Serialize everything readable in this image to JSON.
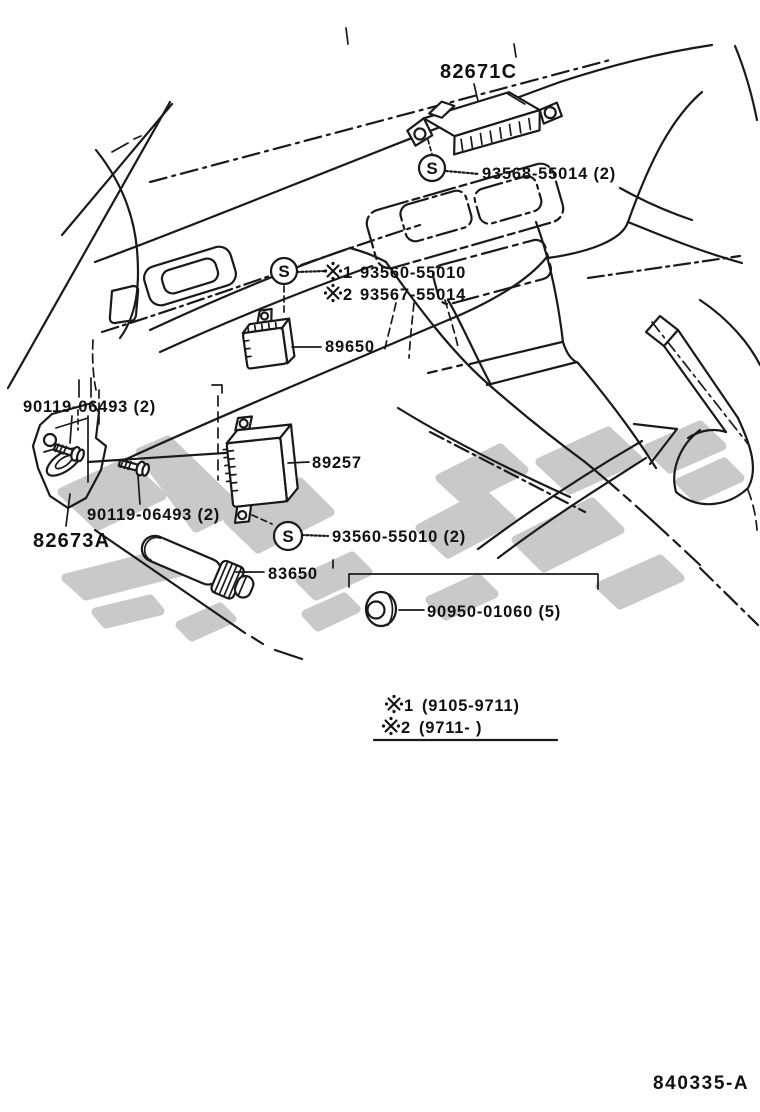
{
  "figure_number": "840335-A",
  "colors": {
    "line": "#1a1a1a",
    "watermark": "#c9c9c9",
    "background": "#ffffff"
  },
  "symbols": {
    "s_marker": "S",
    "reference_mark": "※"
  },
  "callouts": {
    "ecu_82671c": "82671C",
    "screw_93568": "93568-55014 (2)",
    "variant_screw_1": {
      "ref": "1",
      "part": "93560-55010"
    },
    "variant_screw_2": {
      "ref": "2",
      "part": "93567-55014"
    },
    "relay_89650": "89650",
    "screw_90119_upper": "90119-06493 (2)",
    "screw_90119_lower": "90119-06493 (2)",
    "bracket_82673a": "82673A",
    "computer_89257": "89257",
    "screw_93560": "93560-55010 (2)",
    "amplifier_83650": "83650",
    "grommet_90950": "90950-01060 (5)"
  },
  "production_notes": {
    "note1": {
      "ref": "1",
      "range": "(9105-9711)"
    },
    "note2": {
      "ref": "2",
      "range": "(9711-        )"
    }
  }
}
